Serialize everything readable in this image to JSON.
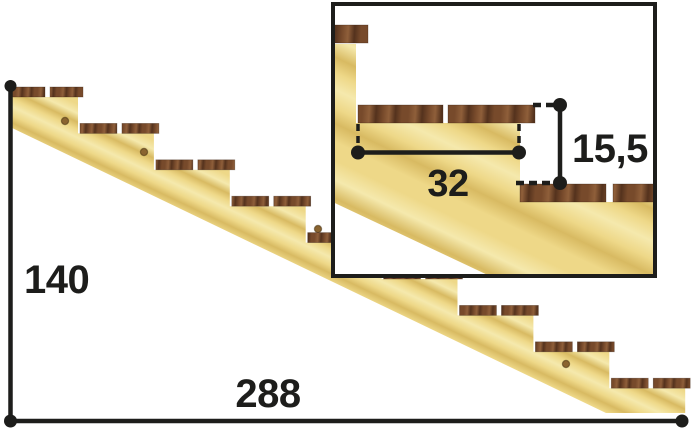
{
  "title": "Stair stringer dimension diagram",
  "main_view": {
    "total_rise_label": "140",
    "total_run_label": "288",
    "step_count": 9
  },
  "detail_view": {
    "tread_depth_label": "32",
    "riser_height_label": "15,5"
  },
  "colors": {
    "line": "#1d1d1b",
    "background": "#ffffff",
    "wood_base": "#eed888",
    "wood_grain_dark": "#d8ba62",
    "wood_grain_light": "#f5e9ad",
    "tread_base": "#774a2b",
    "tread_dark": "#54321d",
    "tread_light": "#8f5f3a",
    "knot": "#8a6430"
  },
  "geometry": {
    "main": {
      "origin_x": 10,
      "top_y": 97,
      "riser1_x": 78,
      "step_dx": 75.9,
      "step_dy": 36.4,
      "steps": 9,
      "board_h": 10,
      "board_overhang": 5,
      "board_gap": 5,
      "left_bottom_y": 127,
      "foot_x": 606,
      "foot_y": 413,
      "knots": [
        [
          65,
          121
        ],
        [
          144,
          152
        ],
        [
          318,
          229
        ],
        [
          566,
          364
        ]
      ]
    },
    "inset": {
      "box": [
        333,
        4,
        322,
        272
      ],
      "stringer": [
        [
          324,
          44
        ],
        [
          356,
          44
        ],
        [
          356,
          123
        ],
        [
          520,
          123
        ],
        [
          520,
          202
        ],
        [
          700,
          202
        ],
        [
          700,
          375
        ],
        [
          320,
          196
        ]
      ],
      "boards": [
        [
          328,
          25,
          40,
          18
        ],
        [
          358,
          105,
          85,
          18
        ],
        [
          448,
          105,
          87,
          18
        ],
        [
          520,
          184,
          86,
          18
        ],
        [
          613,
          184,
          62,
          18
        ]
      ]
    }
  }
}
